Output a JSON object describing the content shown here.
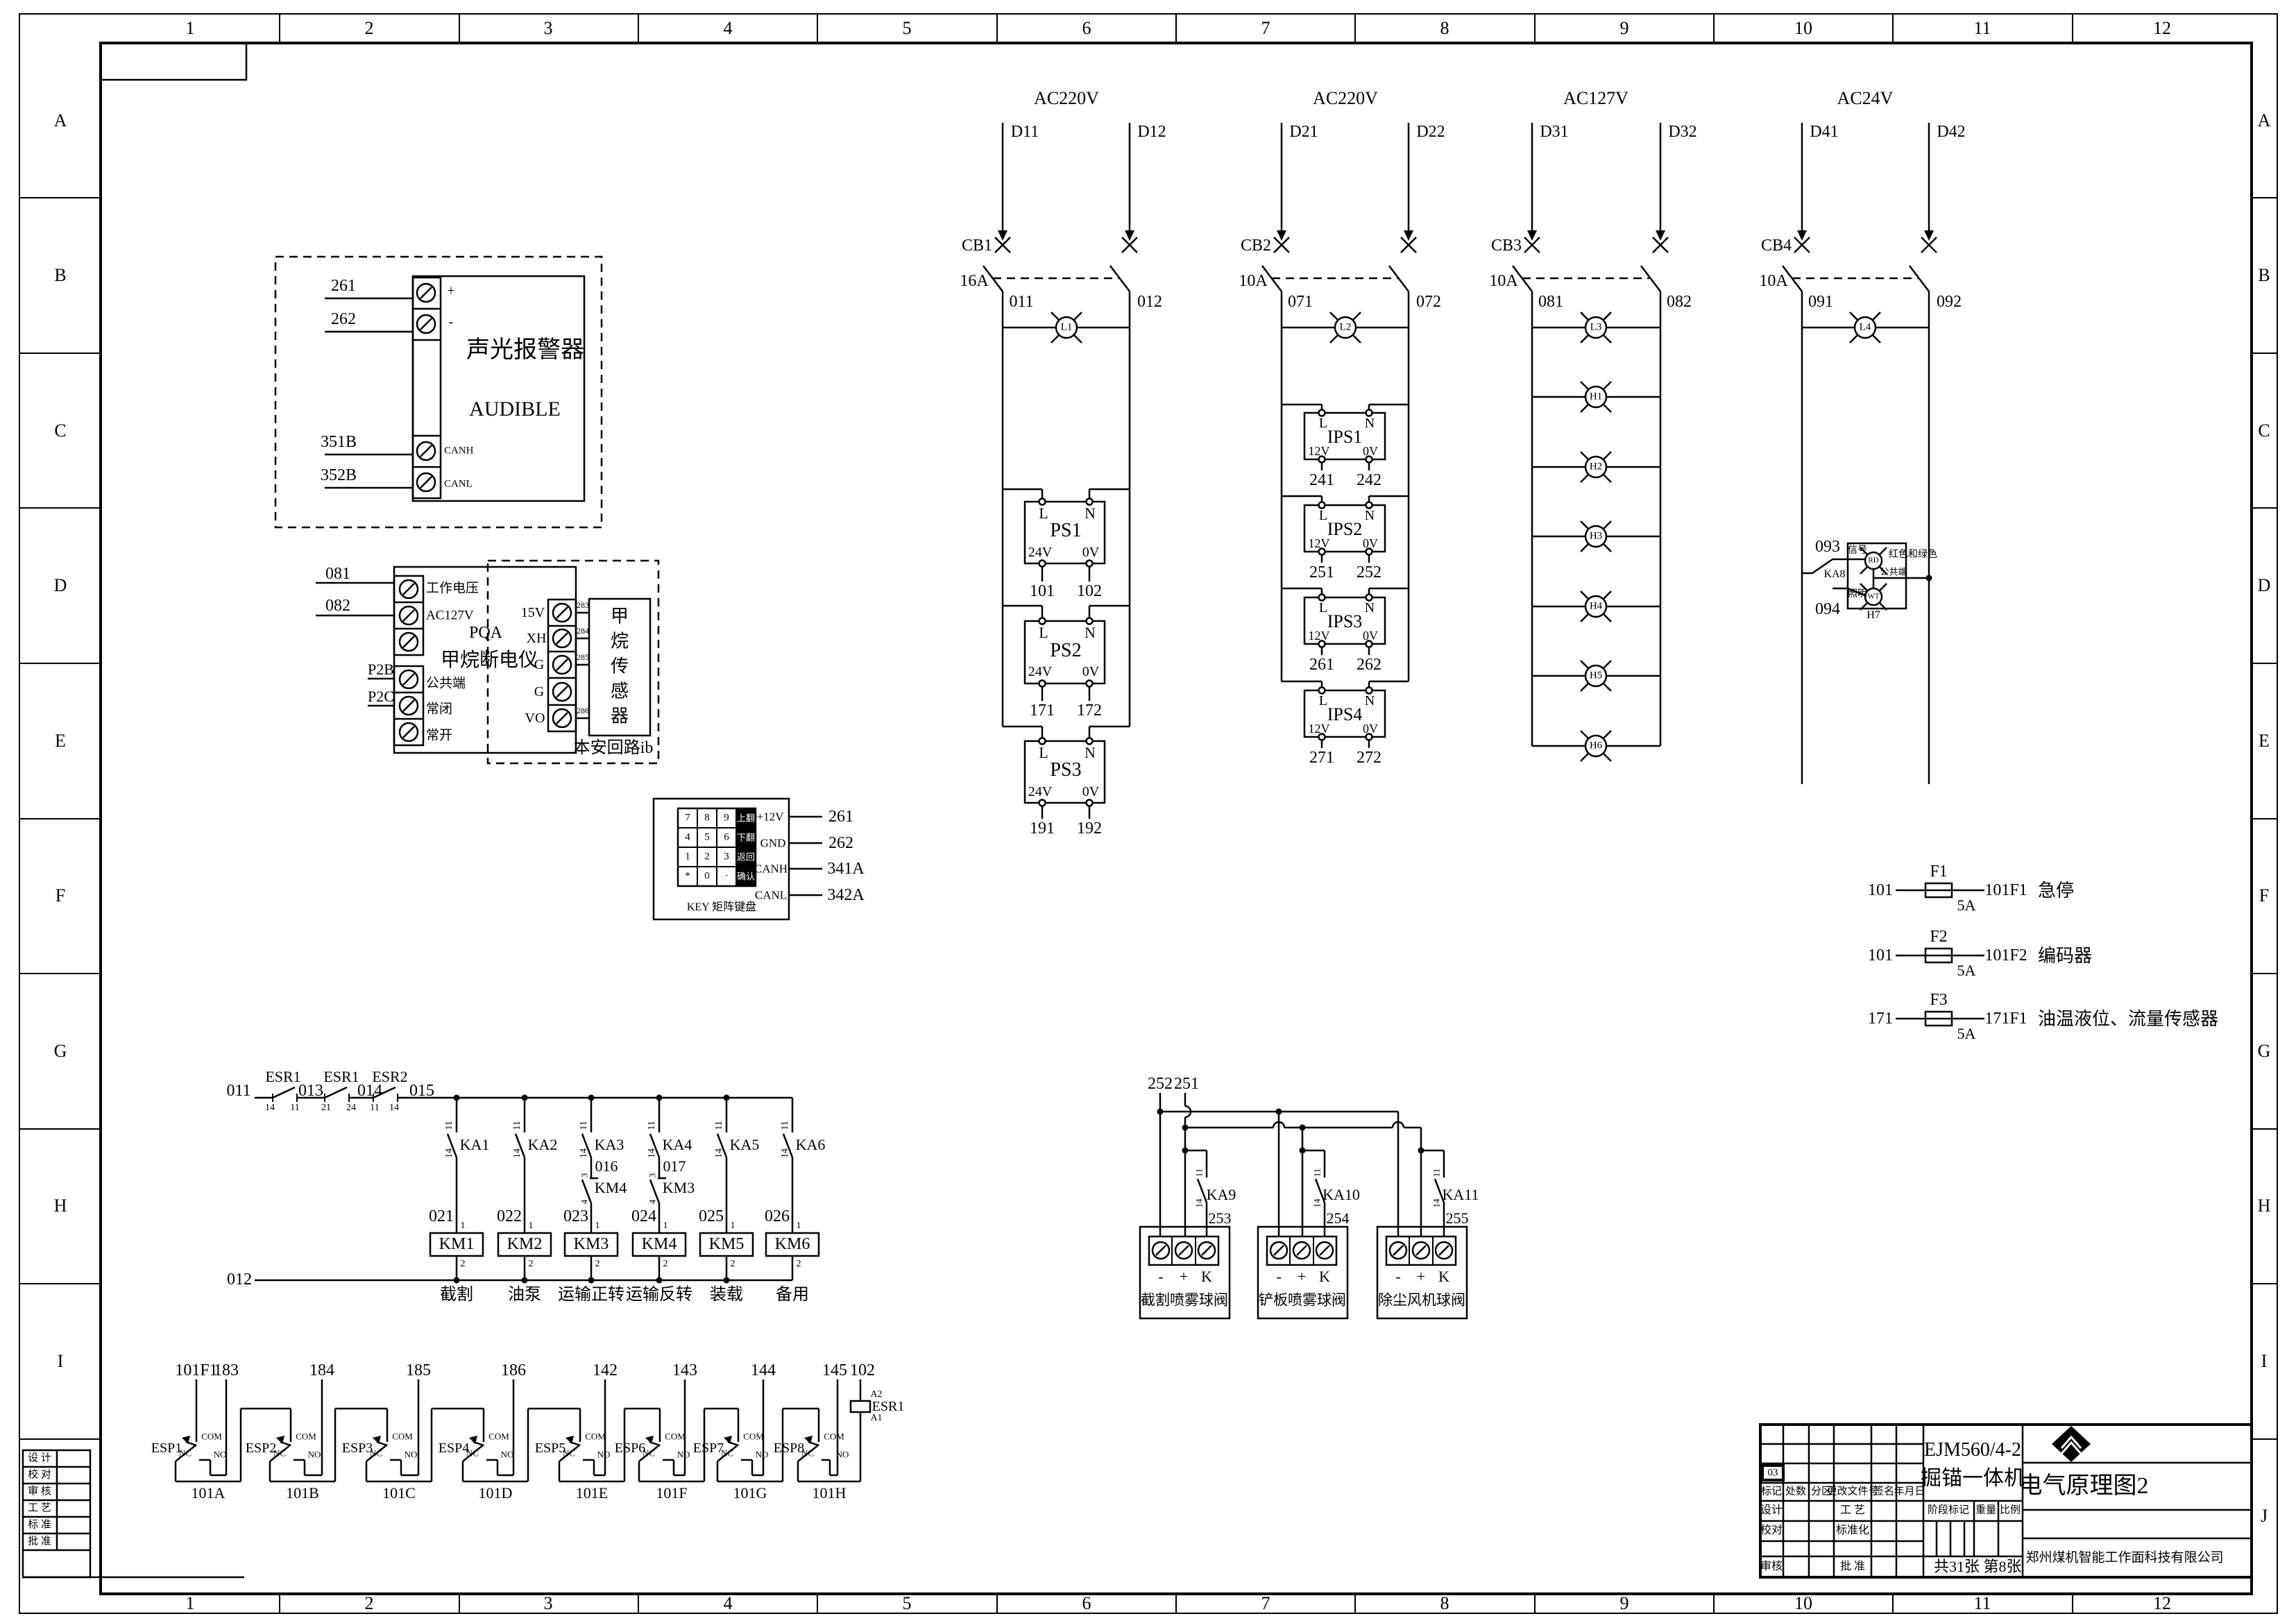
{
  "border": {
    "cols": [
      "1",
      "2",
      "3",
      "4",
      "5",
      "6",
      "7",
      "8",
      "9",
      "10",
      "11",
      "12"
    ],
    "rows": [
      "A",
      "B",
      "C",
      "D",
      "E",
      "F",
      "G",
      "H",
      "I",
      "J"
    ]
  },
  "audible": {
    "w1": "261",
    "w2": "262",
    "w3": "351B",
    "w4": "352B",
    "plus": "+",
    "minus": "-",
    "canh": "CANH",
    "canl": "CANL",
    "title_cn": "声光报警器",
    "title_en": "AUDIBLE"
  },
  "methane": {
    "w081": "081",
    "w082": "082",
    "p2b": "P2B",
    "p2c": "P2C",
    "t_voltage": "工作电压",
    "t_ac127": "AC127V",
    "t_common": "公共端",
    "t_nc": "常闭",
    "t_no": "常开",
    "name": "PQA",
    "name2": "甲烷断电仪",
    "p15v": "15V",
    "xh": "XH",
    "g1": "G",
    "g2": "G",
    "vo": "VO",
    "t283": "283",
    "t284": "284",
    "t285": "285",
    "t286": "286",
    "sensor": "甲烷传感器",
    "loop": "本安回路ib"
  },
  "keypad": {
    "keys": [
      [
        "7",
        "8",
        "9",
        "上翻"
      ],
      [
        "4",
        "5",
        "6",
        "下翻"
      ],
      [
        "1",
        "2",
        "3",
        "返回"
      ],
      [
        "*",
        "0",
        "·",
        "确认"
      ]
    ],
    "pins": [
      "+12V",
      "GND",
      "CANH",
      "CANL"
    ],
    "wires": [
      "261",
      "262",
      "341A",
      "342A"
    ],
    "caption": "KEY 矩阵键盘"
  },
  "feeds": [
    {
      "title": "AC220V",
      "dl": "D11",
      "dr": "D12",
      "cb": "CB1",
      "amp": "16A",
      "nl": "011",
      "nr": "012",
      "lamp": "L1"
    },
    {
      "title": "AC220V",
      "dl": "D21",
      "dr": "D22",
      "cb": "CB2",
      "amp": "10A",
      "nl": "071",
      "nr": "072",
      "lamp": "L2"
    },
    {
      "title": "AC127V",
      "dl": "D31",
      "dr": "D32",
      "cb": "CB3",
      "amp": "10A",
      "nl": "081",
      "nr": "082",
      "lamp": ""
    },
    {
      "title": "AC24V",
      "dl": "D41",
      "dr": "D42",
      "cb": "CB4",
      "amp": "10A",
      "nl": "091",
      "nr": "092",
      "lamp": "L4"
    }
  ],
  "ps": {
    "l": "L",
    "n": "N",
    "v": "24V",
    "zero": "0V",
    "units": [
      {
        "name": "PS1",
        "o1": "101",
        "o2": "102"
      },
      {
        "name": "PS2",
        "o1": "171",
        "o2": "172"
      },
      {
        "name": "PS3",
        "o1": "191",
        "o2": "192"
      }
    ]
  },
  "ips": {
    "l": "L",
    "n": "N",
    "v": "12V",
    "zero": "0V",
    "units": [
      {
        "name": "IPS1",
        "o1": "241",
        "o2": "242"
      },
      {
        "name": "IPS2",
        "o1": "251",
        "o2": "252"
      },
      {
        "name": "IPS3",
        "o1": "261",
        "o2": "262"
      },
      {
        "name": "IPS4",
        "o1": "271",
        "o2": "272"
      }
    ]
  },
  "stack": [
    "L3",
    "H1",
    "H2",
    "H3",
    "H4",
    "H5",
    "H6"
  ],
  "h7": {
    "n093": "093",
    "n094": "094",
    "ka": "KA8",
    "signal": "信号",
    "colors": "红色和绿色",
    "common": "公共端",
    "light": "照明",
    "rd": "RD",
    "wt": "WT",
    "name": "H7"
  },
  "fuses": [
    {
      "in": "101",
      "f": "F1",
      "amp": "5A",
      "out": "101F1",
      "desc": "急停"
    },
    {
      "in": "101",
      "f": "F2",
      "amp": "5A",
      "out": "101F2",
      "desc": "编码器"
    },
    {
      "in": "171",
      "f": "F3",
      "amp": "5A",
      "out": "171F1",
      "desc": "油温液位、流量传感器"
    }
  ],
  "ladder": {
    "n011": "011",
    "n013": "013",
    "n014": "014",
    "n015": "015",
    "n012": "012",
    "c1": {
      "name": "ESR1",
      "a": "14",
      "b": "11"
    },
    "c2": {
      "name": "ESR1",
      "a": "21",
      "b": "24"
    },
    "c3": {
      "name": "ESR2",
      "a": "11",
      "b": "14"
    },
    "branches": [
      {
        "ka": "KA1",
        "t1": "11",
        "t2": "14",
        "node": "021",
        "p1": "1",
        "p2": "2",
        "km": "KM1",
        "func": "截割"
      },
      {
        "ka": "KA2",
        "t1": "11",
        "t2": "14",
        "node": "022",
        "p1": "1",
        "p2": "2",
        "km": "KM2",
        "func": "油泵"
      },
      {
        "ka": "KA3",
        "t1": "11",
        "t2": "14",
        "mid": "016",
        "i1": "3",
        "i2": "4",
        "ilk": "KM4",
        "node": "023",
        "p1": "1",
        "p2": "2",
        "km": "KM3",
        "func": "运输正转"
      },
      {
        "ka": "KA4",
        "t1": "11",
        "t2": "14",
        "mid": "017",
        "i1": "3",
        "i2": "4",
        "ilk": "KM3",
        "node": "024",
        "p1": "1",
        "p2": "2",
        "km": "KM4",
        "func": "运输反转"
      },
      {
        "ka": "KA5",
        "t1": "11",
        "t2": "14",
        "node": "025",
        "p1": "1",
        "p2": "2",
        "km": "KM5",
        "func": "装载"
      },
      {
        "ka": "KA6",
        "t1": "11",
        "t2": "14",
        "node": "026",
        "p1": "1",
        "p2": "2",
        "km": "KM6",
        "func": "备用"
      }
    ]
  },
  "valves": {
    "w252": "252",
    "w251": "251",
    "neg": "-",
    "pos": "+",
    "k": "K",
    "units": [
      {
        "ka": "KA9",
        "t1": "11",
        "t2": "14",
        "wire": "253",
        "name": "截割喷雾球阀"
      },
      {
        "ka": "KA10",
        "t1": "11",
        "t2": "14",
        "wire": "254",
        "name": "铲板喷雾球阀"
      },
      {
        "ka": "KA11",
        "t1": "11",
        "t2": "14",
        "wire": "255",
        "name": "除尘风机球阀"
      }
    ]
  },
  "esp": {
    "tops": [
      "101F1",
      "183",
      "184",
      "185",
      "186",
      "142",
      "143",
      "144",
      "145",
      "102"
    ],
    "units": [
      "ESP1",
      "ESP2",
      "ESP3",
      "ESP4",
      "ESP5",
      "ESP6",
      "ESP7",
      "ESP8"
    ],
    "com": "COM",
    "nc": "NC",
    "no": "NO",
    "buses": [
      "101A",
      "101B",
      "101C",
      "101D",
      "101E",
      "101F",
      "101G",
      "101H"
    ],
    "esr": {
      "a2": "A2",
      "name": "ESR1",
      "a1": "A1"
    }
  },
  "titleblock": {
    "rev": "03",
    "h": [
      "标记",
      "处数",
      "分区",
      "更改文件号",
      "签名",
      "年月日"
    ],
    "r1l": "设计",
    "r1r": "工 艺",
    "r2l": "校对",
    "r2r": "标准化",
    "r3l": "审核",
    "r3r": "批 准",
    "product1": "EJM560/4-2",
    "product2": "掘锚一体机",
    "stage": "阶段标记",
    "weight": "重量",
    "scale": "比例",
    "sheets": "共31张",
    "sheet": "第8张",
    "drawing": "电气原理图2",
    "company": "郑州煤机智能工作面科技有限公司"
  },
  "sig": [
    "设 计",
    "校 对",
    "审 核",
    "工 艺",
    "标 准",
    "批 准"
  ]
}
